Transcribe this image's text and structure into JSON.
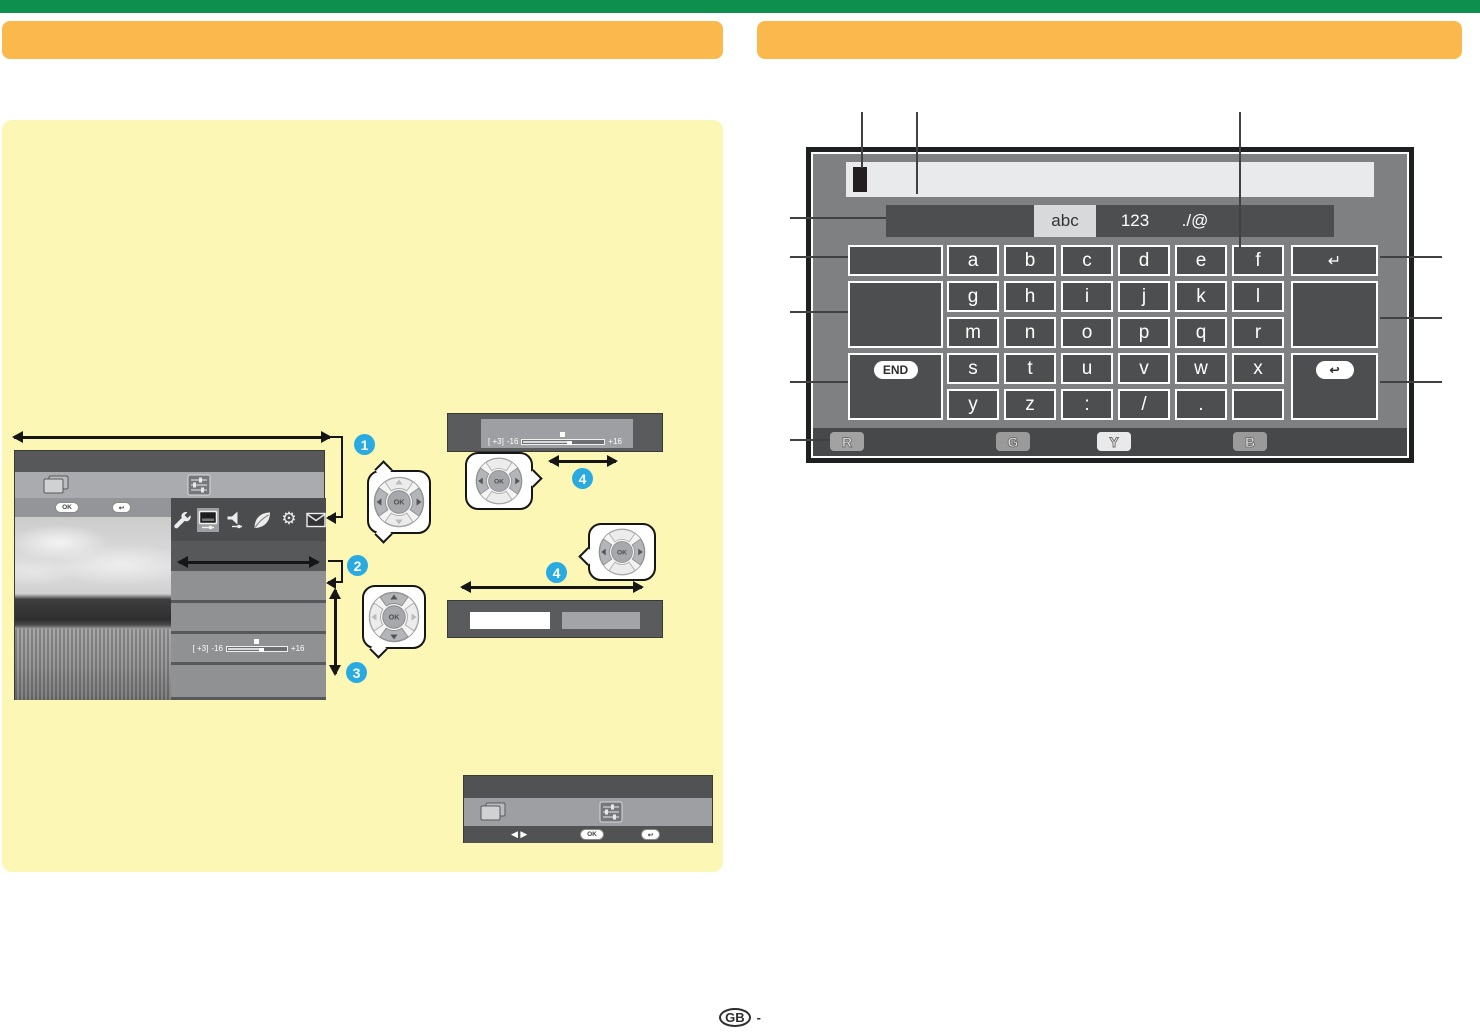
{
  "labels": {
    "ok": "OK",
    "back_glyph": "↩",
    "lr_arrows": "◀ ▶"
  },
  "callouts": {
    "c1": "1",
    "c2": "2",
    "c3": "3",
    "c4": "4"
  },
  "menu_slider": {
    "value": "[ +3]",
    "min": "-16",
    "max": "+16"
  },
  "popup_slider": {
    "value": "[ +3]",
    "min": "-16",
    "max": "+16"
  },
  "keyboard": {
    "tabs": [
      {
        "label": "abc",
        "active": true
      },
      {
        "label": "123",
        "active": false
      },
      {
        "label": "./@",
        "active": false
      }
    ],
    "letters": [
      [
        "a",
        "b",
        "c",
        "d",
        "e",
        "f"
      ],
      [
        "g",
        "h",
        "i",
        "j",
        "k",
        "l"
      ],
      [
        "m",
        "n",
        "o",
        "p",
        "q",
        "r"
      ],
      [
        "s",
        "t",
        "u",
        "v",
        "w",
        "x"
      ],
      [
        "y",
        "z",
        ":",
        "/",
        ".",
        ""
      ]
    ],
    "end_label": "END",
    "enter_glyph": "↵",
    "back_glyph": "↩",
    "color_buttons": [
      "R",
      "G",
      "Y",
      "B"
    ]
  },
  "footer": {
    "region": "GB",
    "dash": "-"
  }
}
